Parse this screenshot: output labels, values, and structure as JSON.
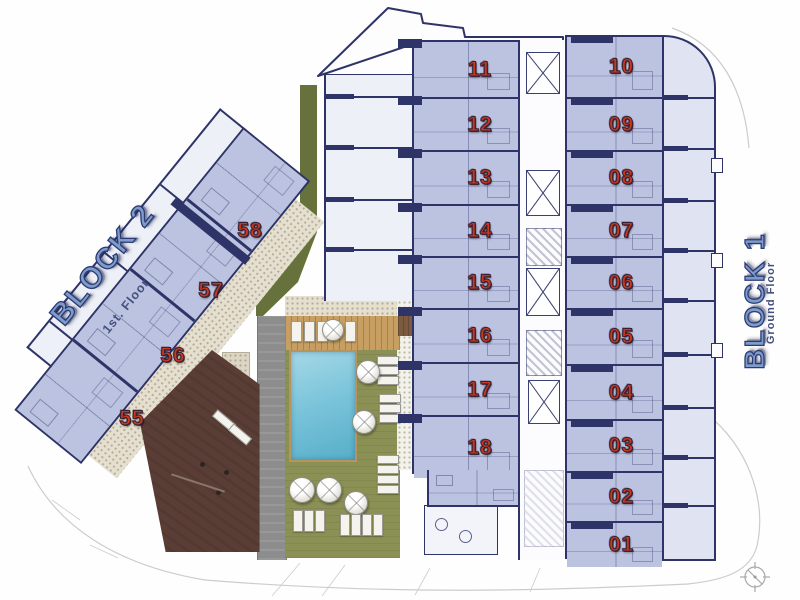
{
  "plan": {
    "block1": {
      "title": "BLOCK 1",
      "subtitle": "Ground Floor",
      "left_units": [
        "11",
        "12",
        "13",
        "14",
        "15",
        "16",
        "17",
        "18"
      ],
      "right_units": [
        "10",
        "09",
        "08",
        "07",
        "06",
        "05",
        "04",
        "03",
        "02",
        "01"
      ]
    },
    "block2": {
      "title": "BLOCK 2",
      "subtitle": "1st. Floor",
      "units": [
        "58",
        "57",
        "56",
        "55"
      ]
    }
  },
  "amenities": {
    "pool": "swimming-pool",
    "deck": "wooden-deck",
    "lawn": "garden-lawn",
    "walkway": "gray-walkway",
    "playground": "playground-area",
    "parasol": "parasol-icon",
    "lounger": "sun-lounger",
    "compass": "compass-rose-icon"
  },
  "colors": {
    "apartment_fill": "#bcc3e1",
    "wall_line": "#2e3468",
    "unit_number_red": "#c8391f",
    "title_blue": "#7d9ccb",
    "pool_blue": "#7cc5db",
    "lawn_green": "#8b9155",
    "deck_tan": "#c79f63",
    "walkway_gray": "#8d8d8d",
    "playground_brown": "#5a3e36",
    "paving_beige": "#e5dfcf",
    "hedge_green": "#66713c"
  }
}
